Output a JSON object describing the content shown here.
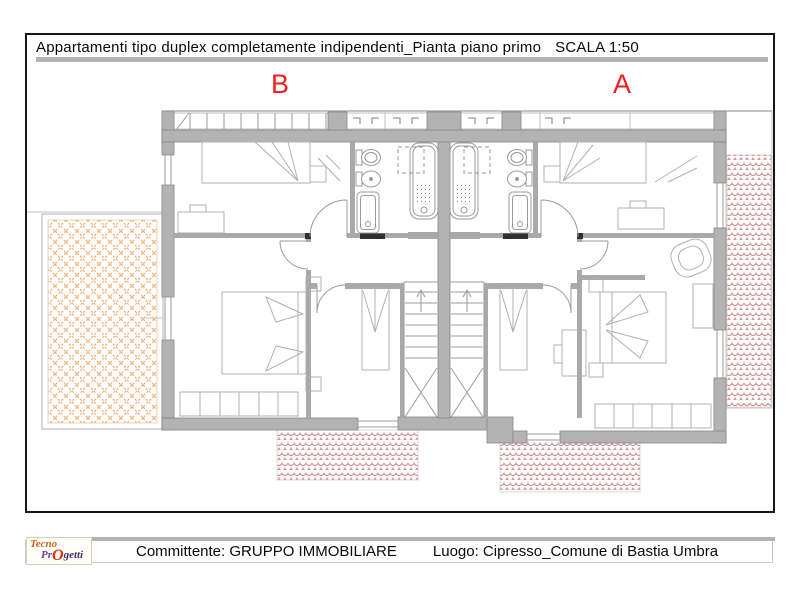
{
  "header": {
    "title": "Appartamenti tipo duplex completamente indipendenti_Pianta piano primo",
    "scale": "SCALA 1:50"
  },
  "plan": {
    "label_b": "B",
    "label_a": "A"
  },
  "footer": {
    "client": "Committente: GRUPPO IMMOBILIARE",
    "location": "Luogo: Cipresso_Comune di Bastia Umbra"
  },
  "logo": {
    "line1": "Tecno",
    "line2_pre": "Pr",
    "line2_o": "O",
    "line2_post": "getti"
  },
  "colors": {
    "accent_red": "#f01e1e",
    "bar_gray": "#b3b3b3",
    "wall_gray": "#b3b3b3",
    "hatch_orange": "#f2ae72",
    "hatch_red": "#c98080"
  }
}
